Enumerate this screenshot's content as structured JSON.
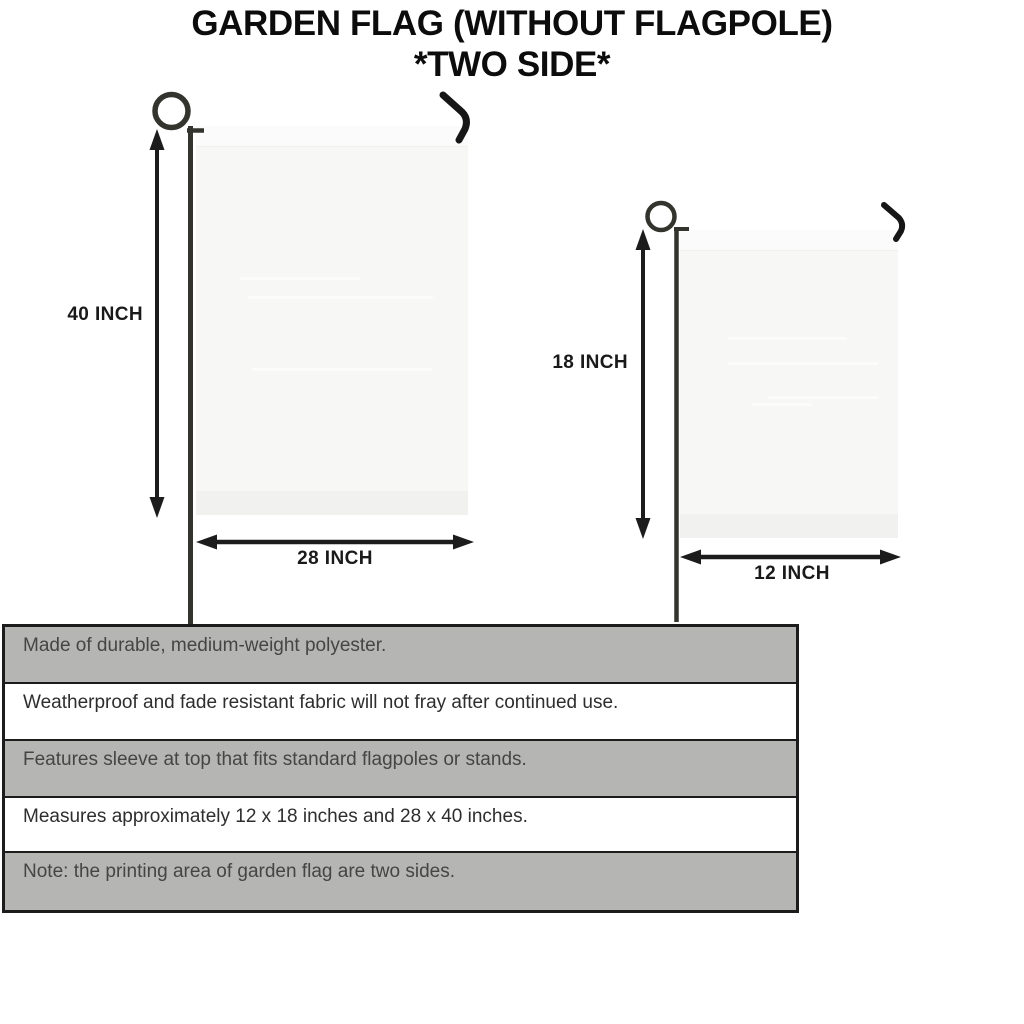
{
  "title": {
    "line1": "GARDEN FLAG (WITHOUT FLAGPOLE)",
    "line2": "*TWO SIDE*"
  },
  "diagram": {
    "large_flag": {
      "height_label": "40 INCH",
      "width_label": "28 INCH"
    },
    "small_flag": {
      "height_label": "18 INCH",
      "width_label": "12 INCH"
    }
  },
  "features_table": {
    "rows": [
      {
        "text": "Made of durable, medium-weight polyester."
      },
      {
        "text": "Weatherproof and fade resistant fabric will not fray after continued use."
      },
      {
        "text": "Features sleeve at top that fits standard flagpoles or stands."
      },
      {
        "text": "Measures approximately 12 x 18 inches and 28 x 40 inches."
      },
      {
        "text": "Note: the printing area of garden flag are two sides."
      }
    ]
  },
  "colors": {
    "flag_fill": "#f7f7f5",
    "pole": "#34342e",
    "hook": "#161616",
    "arrow": "#1c1c1c",
    "table_shaded": "#b5b5b4",
    "table_border": "#1c1c1c",
    "title_text": "#0c0c0c"
  }
}
